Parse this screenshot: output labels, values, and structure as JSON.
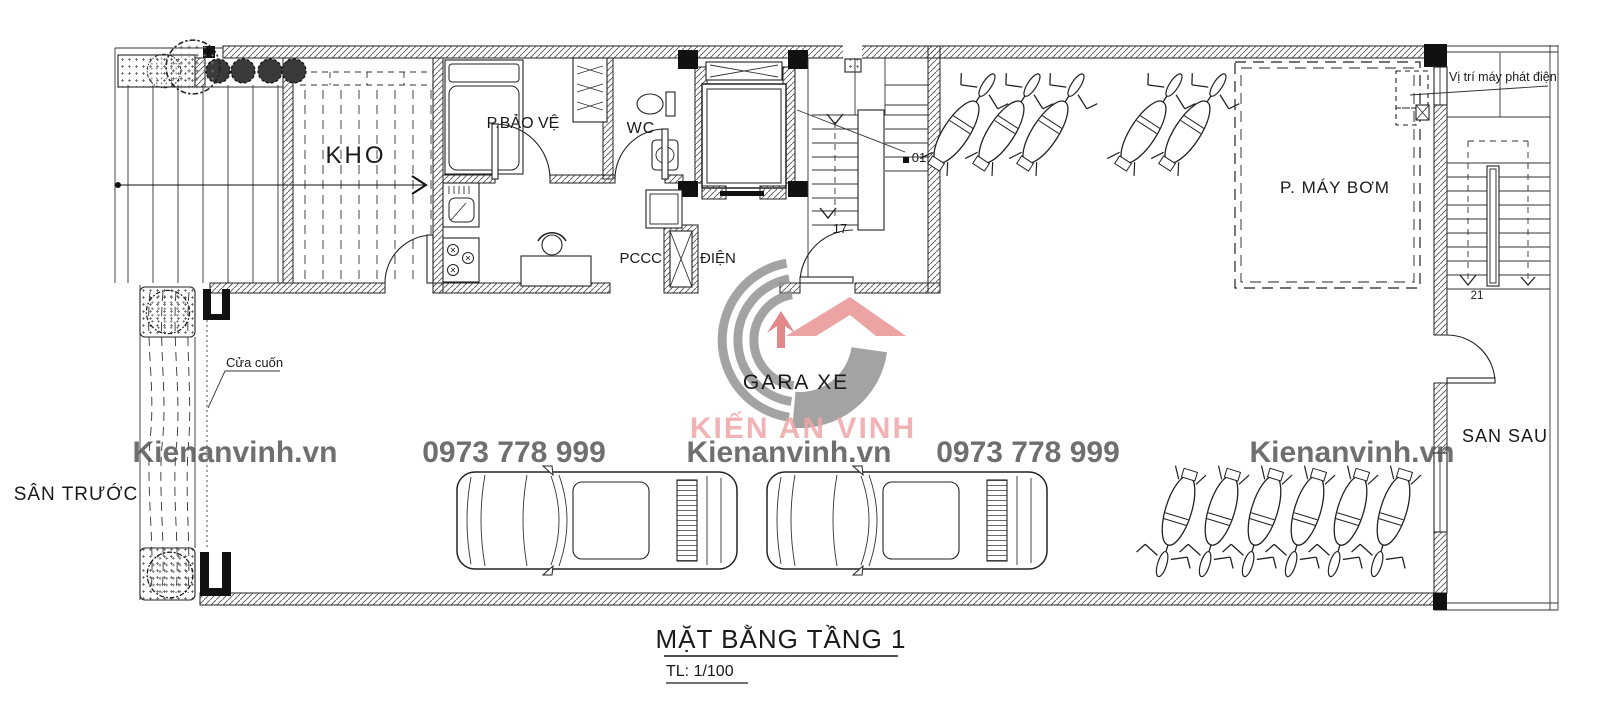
{
  "drawing": {
    "title": "MẶT BẰNG TẦNG 1",
    "scale_label": "TL: 1/100"
  },
  "rooms": {
    "storage": "KHO",
    "security": "P.BẢO VỆ",
    "toilet": "WC",
    "fire_protection": "PCCC",
    "electrical": "ĐIỆN",
    "garage": "GARA XE",
    "pump_room": "P. MÁY BƠM",
    "front_yard": "SÂN TRƯỚC",
    "back_yard": "SAN SAU"
  },
  "annotations": {
    "rolling_door": "Cửa cuốn",
    "generator_location": "Vị trí máy phát điện",
    "stair_marker_01": "01",
    "stair_marker_17": "17",
    "stair_marker_21": "21"
  },
  "watermark": {
    "brand": "KIẾN AN VINH",
    "website": "Kienanvinh.vn",
    "phone": "0973 778 999"
  },
  "colors": {
    "line": "#1a1a1a",
    "logo_gray": "#8f8f8f",
    "watermark_gray": "#565656",
    "brand_pink": "#efa6a6",
    "roof_red": "#e98f8f",
    "arrow_red": "#de6e6e"
  }
}
